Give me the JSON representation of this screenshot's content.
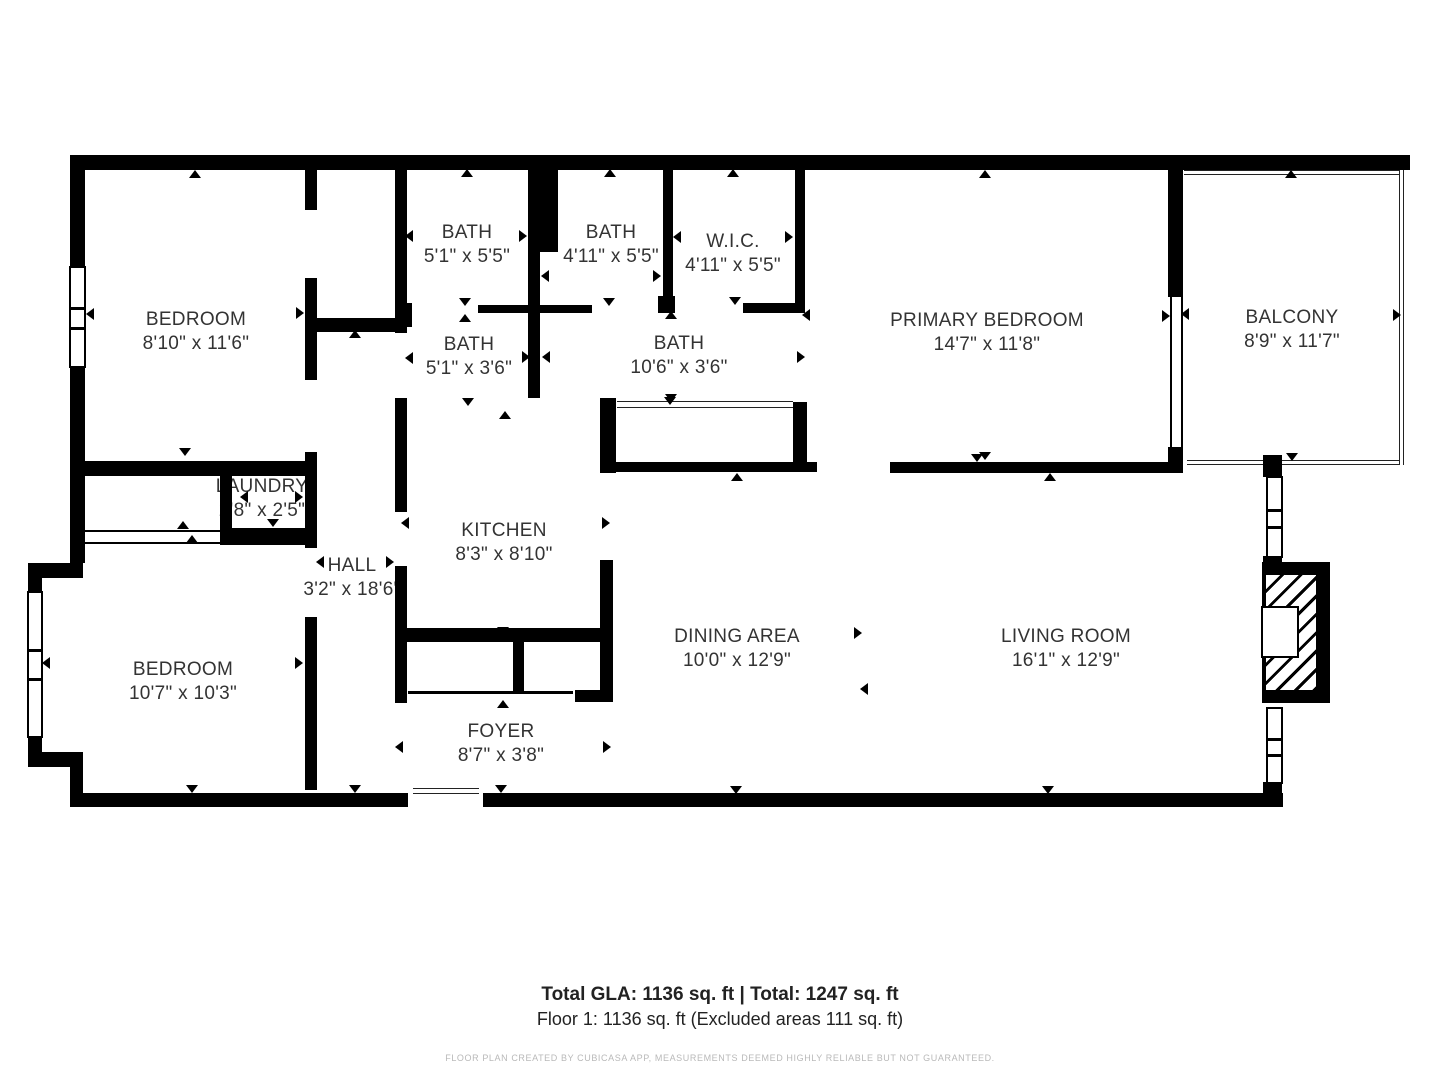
{
  "title": "Floor plan",
  "footer": {
    "total_line": "Total GLA: 1136 sq. ft | Total: 1247 sq. ft",
    "floor_line": "Floor 1: 1136 sq. ft (Excluded areas 111 sq. ft)",
    "disclaimer": "FLOOR PLAN CREATED BY CUBICASA APP, MEASUREMENTS DEEMED HIGHLY RELIABLE BUT NOT GUARANTEED."
  },
  "colors": {
    "wall": "#000000",
    "label_text": "#333333",
    "disclaimer_text": "#b9b9b9",
    "background": "#ffffff"
  },
  "rooms": [
    {
      "name": "BEDROOM",
      "dims": "8'10\" x 11'6\"",
      "cx": 196,
      "cy": 332
    },
    {
      "name": "BATH",
      "dims": "5'1\" x 5'5\"",
      "cx": 467,
      "cy": 245
    },
    {
      "name": "BATH",
      "dims": "4'11\" x 5'5\"",
      "cx": 611,
      "cy": 245
    },
    {
      "name": "W.I.C.",
      "dims": "4'11\" x 5'5\"",
      "cx": 733,
      "cy": 254
    },
    {
      "name": "PRIMARY BEDROOM",
      "dims": "14'7\" x 11'8\"",
      "cx": 987,
      "cy": 333
    },
    {
      "name": "BALCONY",
      "dims": "8'9\" x 11'7\"",
      "cx": 1292,
      "cy": 330
    },
    {
      "name": "BATH",
      "dims": "5'1\" x 3'6\"",
      "cx": 469,
      "cy": 357
    },
    {
      "name": "BATH",
      "dims": "10'6\" x 3'6\"",
      "cx": 679,
      "cy": 356
    },
    {
      "name": "LAUNDRY",
      "dims": "2'8\" x 2'5\"",
      "cx": 262,
      "cy": 499
    },
    {
      "name": "HALL",
      "dims": "3'2\" x 18'6\"",
      "cx": 352,
      "cy": 578
    },
    {
      "name": "KITCHEN",
      "dims": "8'3\" x 8'10\"",
      "cx": 504,
      "cy": 543
    },
    {
      "name": "BEDROOM",
      "dims": "10'7\" x 10'3\"",
      "cx": 183,
      "cy": 682
    },
    {
      "name": "DINING AREA",
      "dims": "10'0\" x 12'9\"",
      "cx": 737,
      "cy": 649
    },
    {
      "name": "LIVING ROOM",
      "dims": "16'1\" x 12'9\"",
      "cx": 1066,
      "cy": 649
    },
    {
      "name": "FOYER",
      "dims": "8'7\" x 3'8\"",
      "cx": 501,
      "cy": 744
    }
  ],
  "walls": [
    [
      70,
      155,
      1340,
      15
    ],
    [
      70,
      170,
      15,
      96
    ],
    [
      70,
      368,
      15,
      195
    ],
    [
      28,
      563,
      55,
      15
    ],
    [
      28,
      578,
      14,
      14
    ],
    [
      28,
      737,
      14,
      30
    ],
    [
      28,
      752,
      55,
      15
    ],
    [
      70,
      767,
      13,
      26
    ],
    [
      70,
      793,
      338,
      14
    ],
    [
      483,
      793,
      800,
      14
    ],
    [
      70,
      461,
      247,
      15
    ],
    [
      220,
      476,
      12,
      52
    ],
    [
      220,
      528,
      97,
      17
    ],
    [
      305,
      170,
      12,
      40
    ],
    [
      305,
      278,
      12,
      102
    ],
    [
      305,
      452,
      12,
      96
    ],
    [
      305,
      617,
      12,
      173
    ],
    [
      317,
      318,
      80,
      14
    ],
    [
      395,
      170,
      12,
      163
    ],
    [
      395,
      303,
      17,
      24
    ],
    [
      395,
      398,
      12,
      114
    ],
    [
      395,
      566,
      12,
      137
    ],
    [
      528,
      170,
      12,
      228
    ],
    [
      528,
      170,
      30,
      82
    ],
    [
      478,
      305,
      114,
      8
    ],
    [
      663,
      170,
      10,
      133
    ],
    [
      658,
      296,
      17,
      17
    ],
    [
      743,
      303,
      62,
      10
    ],
    [
      795,
      170,
      10,
      143
    ],
    [
      600,
      398,
      16,
      75
    ],
    [
      793,
      402,
      14,
      70
    ],
    [
      603,
      462,
      214,
      10
    ],
    [
      890,
      462,
      278,
      11
    ],
    [
      1168,
      170,
      15,
      127
    ],
    [
      1168,
      447,
      15,
      26
    ],
    [
      1263,
      455,
      19,
      22
    ],
    [
      1263,
      556,
      19,
      8
    ],
    [
      1263,
      782,
      19,
      12
    ],
    [
      600,
      560,
      13,
      140
    ],
    [
      575,
      690,
      38,
      12
    ],
    [
      400,
      628,
      210,
      14
    ],
    [
      513,
      642,
      11,
      49
    ]
  ],
  "solid_lines": [
    [
      85,
      530,
      135,
      2
    ],
    [
      85,
      542,
      135,
      2
    ],
    [
      408,
      691,
      165,
      3
    ],
    [
      1170,
      297,
      2,
      151
    ],
    [
      1181,
      297,
      2,
      151
    ]
  ],
  "double_lines_h": [
    [
      617,
      401,
      176,
      7
    ],
    [
      1184,
      170,
      220,
      5
    ],
    [
      1187,
      460,
      217,
      5
    ],
    [
      413,
      788,
      66,
      6
    ]
  ],
  "double_lines_v": [
    [
      1399,
      170,
      5,
      295
    ]
  ],
  "windows": [
    [
      69,
      266,
      17,
      102
    ],
    [
      27,
      591,
      16,
      147
    ],
    [
      1266,
      476,
      17,
      82
    ],
    [
      1266,
      707,
      17,
      77
    ]
  ],
  "fireplace": {
    "box": [
      1262,
      562,
      68,
      141
    ],
    "hatch": [
      1265,
      574,
      52,
      117
    ],
    "firebox": [
      1261,
      606,
      38,
      52
    ]
  },
  "markers": [
    [
      195,
      174,
      "u"
    ],
    [
      185,
      452,
      "d"
    ],
    [
      90,
      314,
      "l"
    ],
    [
      300,
      313,
      "r"
    ],
    [
      355,
      334,
      "u"
    ],
    [
      320,
      562,
      "l"
    ],
    [
      390,
      562,
      "r"
    ],
    [
      355,
      789,
      "d"
    ],
    [
      275,
      472,
      "u"
    ],
    [
      244,
      497,
      "l"
    ],
    [
      299,
      497,
      "r"
    ],
    [
      273,
      523,
      "d"
    ],
    [
      183,
      525,
      "u"
    ],
    [
      192,
      539,
      "u"
    ],
    [
      46,
      663,
      "l"
    ],
    [
      299,
      663,
      "r"
    ],
    [
      192,
      789,
      "d"
    ],
    [
      467,
      173,
      "u"
    ],
    [
      409,
      236,
      "l"
    ],
    [
      523,
      236,
      "r"
    ],
    [
      465,
      302,
      "d"
    ],
    [
      465,
      318,
      "u"
    ],
    [
      610,
      173,
      "u"
    ],
    [
      545,
      276,
      "l"
    ],
    [
      657,
      276,
      "r"
    ],
    [
      609,
      302,
      "d"
    ],
    [
      733,
      173,
      "u"
    ],
    [
      677,
      237,
      "l"
    ],
    [
      789,
      237,
      "r"
    ],
    [
      735,
      301,
      "d"
    ],
    [
      671,
      315,
      "u"
    ],
    [
      671,
      398,
      "d"
    ],
    [
      806,
      315,
      "l"
    ],
    [
      801,
      357,
      "r"
    ],
    [
      409,
      358,
      "l"
    ],
    [
      526,
      357,
      "r"
    ],
    [
      546,
      357,
      "l"
    ],
    [
      670,
      401,
      "d"
    ],
    [
      737,
      477,
      "u"
    ],
    [
      985,
      174,
      "u"
    ],
    [
      985,
      456,
      "d"
    ],
    [
      1050,
      477,
      "u"
    ],
    [
      977,
      458,
      "d"
    ],
    [
      1166,
      316,
      "r"
    ],
    [
      1185,
      314,
      "l"
    ],
    [
      1291,
      174,
      "u"
    ],
    [
      1292,
      457,
      "d"
    ],
    [
      1397,
      315,
      "r"
    ],
    [
      468,
      402,
      "d"
    ],
    [
      505,
      415,
      "u"
    ],
    [
      405,
      523,
      "l"
    ],
    [
      606,
      523,
      "r"
    ],
    [
      503,
      631,
      "d"
    ],
    [
      503,
      704,
      "u"
    ],
    [
      399,
      747,
      "l"
    ],
    [
      607,
      747,
      "r"
    ],
    [
      501,
      789,
      "d"
    ],
    [
      858,
      633,
      "r"
    ],
    [
      864,
      689,
      "l"
    ],
    [
      736,
      790,
      "d"
    ],
    [
      1048,
      790,
      "d"
    ]
  ]
}
